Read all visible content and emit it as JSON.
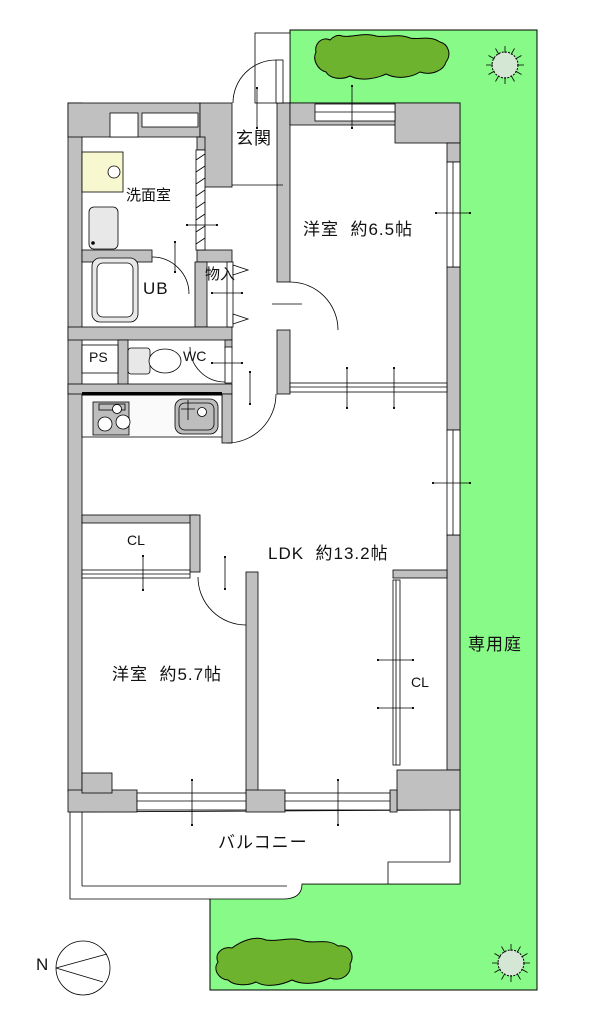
{
  "rooms": {
    "genkan": {
      "label": "玄関"
    },
    "senmen": {
      "label": "洗面室"
    },
    "ub": {
      "label": "UB"
    },
    "monoire": {
      "label": "物入"
    },
    "ps": {
      "label": "PS"
    },
    "wc": {
      "label": "WC"
    },
    "yoshitsu65": {
      "label": "洋室  約6.5帖"
    },
    "ldk": {
      "label": "LDK  約13.2帖"
    },
    "cl1": {
      "label": "CL"
    },
    "yoshitsu57": {
      "label": "洋室  約5.7帖"
    },
    "cl2": {
      "label": "CL"
    },
    "balcony": {
      "label": "バルコニー"
    },
    "garden": {
      "label": "専用庭"
    }
  },
  "compass": {
    "label": "N"
  },
  "colors": {
    "wall": "#c0c0c0",
    "garden": "#87fa87",
    "shrub": "#6db32e",
    "tree": "#d4e6d4",
    "vanity": "#f7f7d0",
    "fixture": "#e8e8e8",
    "kitchen": "#bdbdbd",
    "counter": "#fafafa"
  }
}
